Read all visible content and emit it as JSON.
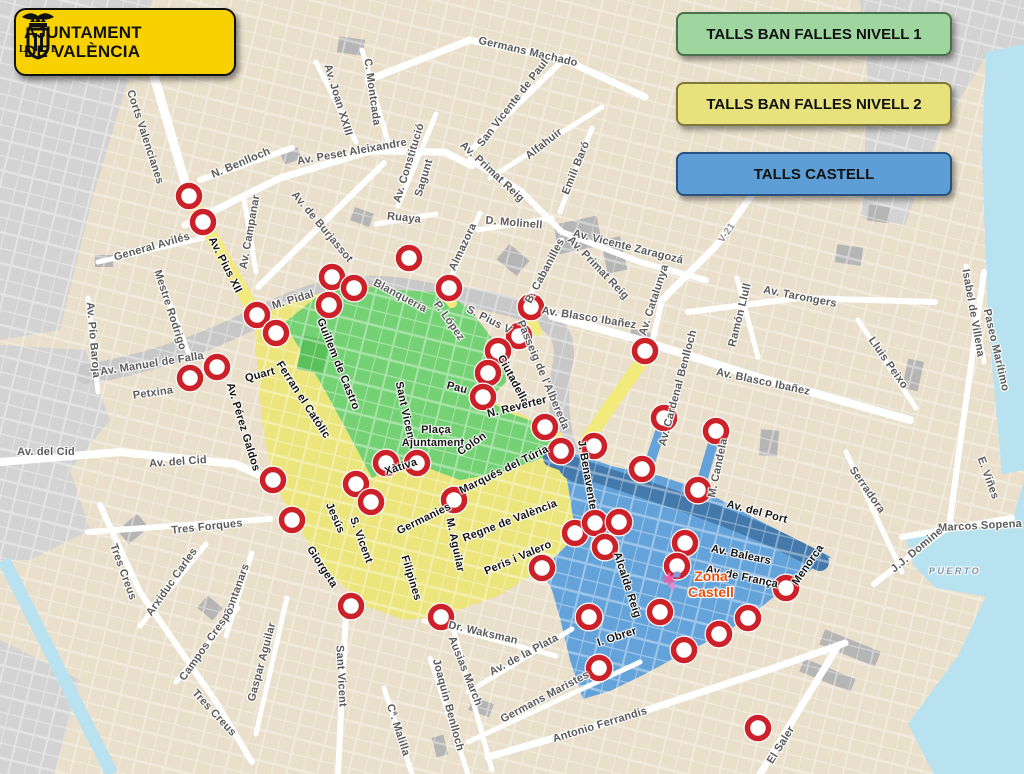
{
  "badge": {
    "line1": "AJUNTAMENT",
    "line2": "DE VALÈNCIA"
  },
  "legend": [
    {
      "label": "TALLS BAN FALLES NIVELL 1",
      "fill": "#9fd6a0",
      "border": "#47714d"
    },
    {
      "label": "TALLS BAN FALLES NIVELL 2",
      "fill": "#e7e27b",
      "border": "#7d7839"
    },
    {
      "label": "TALLS CASTELL",
      "fill": "#5d9ed6",
      "border": "#27517e"
    }
  ],
  "colors": {
    "nivell1": "#74d274",
    "nivell2": "#ece57c",
    "castell": "#64a3da",
    "river": "#4479ab",
    "riverbed": "#c8c8c8",
    "water": "#b8e2ef",
    "margin_gray": "#d3d3d3",
    "building_gray": "#b5b5b5",
    "road_highlight": "#f2ea7a",
    "marker_ring": "#cc2128",
    "marker_fill": "#ffffff",
    "badge_yellow": "#f8d200",
    "park_green": "#5ac05a",
    "zona_castell_text": "#e8500f"
  },
  "zona_castell": {
    "line1": "Zona",
    "line2": "Castell"
  },
  "icons": {
    "fireworks": [
      "✱",
      "✸",
      "✹"
    ]
  },
  "markers": [
    [
      189,
      196
    ],
    [
      203,
      222
    ],
    [
      332,
      277
    ],
    [
      354,
      288
    ],
    [
      329,
      305
    ],
    [
      257,
      315
    ],
    [
      276,
      333
    ],
    [
      217,
      367
    ],
    [
      190,
      378
    ],
    [
      409,
      258
    ],
    [
      449,
      288
    ],
    [
      531,
      307
    ],
    [
      519,
      336
    ],
    [
      498,
      351
    ],
    [
      488,
      373
    ],
    [
      483,
      397
    ],
    [
      545,
      427
    ],
    [
      645,
      351
    ],
    [
      664,
      418
    ],
    [
      716,
      431
    ],
    [
      594,
      446
    ],
    [
      561,
      451
    ],
    [
      642,
      469
    ],
    [
      698,
      490
    ],
    [
      273,
      480
    ],
    [
      292,
      520
    ],
    [
      356,
      484
    ],
    [
      371,
      502
    ],
    [
      386,
      463
    ],
    [
      417,
      463
    ],
    [
      454,
      500
    ],
    [
      351,
      606
    ],
    [
      441,
      617
    ],
    [
      575,
      533
    ],
    [
      595,
      523
    ],
    [
      619,
      522
    ],
    [
      605,
      547
    ],
    [
      542,
      568
    ],
    [
      685,
      543
    ],
    [
      677,
      566
    ],
    [
      589,
      617
    ],
    [
      660,
      612
    ],
    [
      786,
      588
    ],
    [
      748,
      618
    ],
    [
      719,
      634
    ],
    [
      684,
      650
    ],
    [
      599,
      668
    ],
    [
      758,
      728
    ]
  ],
  "labels": [
    {
      "t": "Germans Machado",
      "x": 528,
      "y": 52,
      "r": 13
    },
    {
      "t": "C. Montcada",
      "x": 372,
      "y": 92,
      "r": 82
    },
    {
      "t": "Av. Joan XXIII",
      "x": 338,
      "y": 100,
      "r": 73
    },
    {
      "t": "Av. Peset Aleixandre",
      "x": 352,
      "y": 152,
      "r": -10
    },
    {
      "t": "Av. Constitució",
      "x": 409,
      "y": 163,
      "r": -73
    },
    {
      "t": "Sagunt",
      "x": 424,
      "y": 178,
      "r": -73
    },
    {
      "t": "San Vicente de Paul",
      "x": 513,
      "y": 103,
      "r": -52
    },
    {
      "t": "Av. Primat Reig",
      "x": 492,
      "y": 172,
      "r": 43
    },
    {
      "t": "Alfahuir",
      "x": 544,
      "y": 144,
      "r": -38
    },
    {
      "t": "Emili Baró",
      "x": 576,
      "y": 168,
      "r": -68
    },
    {
      "t": "N. Benlloch",
      "x": 241,
      "y": 163,
      "r": -23
    },
    {
      "t": "Corts Valencianes",
      "x": 145,
      "y": 137,
      "r": 72
    },
    {
      "t": "Ruaya",
      "x": 404,
      "y": 218,
      "r": 6
    },
    {
      "t": "D. Molinell",
      "x": 514,
      "y": 223,
      "r": 5
    },
    {
      "t": "Almazora",
      "x": 463,
      "y": 247,
      "r": -65
    },
    {
      "t": "B. Cabanilles",
      "x": 545,
      "y": 271,
      "r": -62
    },
    {
      "t": "Av. Vicente Zaragozá",
      "x": 628,
      "y": 247,
      "r": 14
    },
    {
      "t": "Av. Primat Reig",
      "x": 598,
      "y": 268,
      "r": 46
    },
    {
      "t": "Av. Catalunya",
      "x": 654,
      "y": 300,
      "r": -72
    },
    {
      "t": "V-21",
      "x": 727,
      "y": 233,
      "r": -55,
      "k": "v"
    },
    {
      "t": "Av. Tarongers",
      "x": 800,
      "y": 297,
      "r": 11
    },
    {
      "t": "Ramón Llull",
      "x": 740,
      "y": 315,
      "r": -76
    },
    {
      "t": "Av. Blasco Ibañez",
      "x": 589,
      "y": 318,
      "r": 9
    },
    {
      "t": "Av. Blasco Ibañez",
      "x": 763,
      "y": 382,
      "r": 12
    },
    {
      "t": "Av. de Burjassot",
      "x": 322,
      "y": 227,
      "r": 50
    },
    {
      "t": "Av. Campanar",
      "x": 250,
      "y": 232,
      "r": -80
    },
    {
      "t": "Av. Pius XII",
      "x": 225,
      "y": 265,
      "r": 63,
      "k": "z"
    },
    {
      "t": "M. Pidal",
      "x": 293,
      "y": 300,
      "r": -17
    },
    {
      "t": "Mestre Rodrigo",
      "x": 170,
      "y": 310,
      "r": 72
    },
    {
      "t": "Av. Pío Baroja",
      "x": 93,
      "y": 340,
      "r": 85
    },
    {
      "t": "Av. Manuel de Falla",
      "x": 152,
      "y": 364,
      "r": -9
    },
    {
      "t": "Petxina",
      "x": 153,
      "y": 393,
      "r": -8
    },
    {
      "t": "Av. del Cid",
      "x": 46,
      "y": 452,
      "r": 0
    },
    {
      "t": "Av. del Cid",
      "x": 178,
      "y": 462,
      "r": -4
    },
    {
      "t": "General Avilés",
      "x": 152,
      "y": 247,
      "r": -16
    },
    {
      "t": "Blanqueria",
      "x": 400,
      "y": 296,
      "r": 28
    },
    {
      "t": "P. López",
      "x": 449,
      "y": 321,
      "r": 55
    },
    {
      "t": "S. Pius V",
      "x": 489,
      "y": 320,
      "r": 27
    },
    {
      "t": "Guillem de  Castro",
      "x": 338,
      "y": 364,
      "r": 68,
      "k": "z"
    },
    {
      "t": "Ferran el Catòlic",
      "x": 303,
      "y": 400,
      "r": 57,
      "k": "z"
    },
    {
      "t": "Quart",
      "x": 260,
      "y": 375,
      "r": -15,
      "k": "z"
    },
    {
      "t": "Av. Pérez Galdos",
      "x": 243,
      "y": 427,
      "r": 73,
      "k": "z"
    },
    {
      "t": "Sant Vicent",
      "x": 405,
      "y": 412,
      "r": 78,
      "k": "z"
    },
    {
      "t": "Pau",
      "x": 457,
      "y": 388,
      "r": 15,
      "k": "z"
    },
    {
      "t": "Plaça",
      "x": 436,
      "y": 430,
      "r": 0,
      "k": "z"
    },
    {
      "t": "Ajuntament",
      "x": 433,
      "y": 443,
      "r": 0,
      "k": "z"
    },
    {
      "t": "Colón",
      "x": 472,
      "y": 444,
      "r": -35,
      "k": "z"
    },
    {
      "t": "Ciutadella",
      "x": 513,
      "y": 380,
      "r": 62,
      "k": "z"
    },
    {
      "t": "N. Reverter",
      "x": 517,
      "y": 407,
      "r": -14,
      "k": "z"
    },
    {
      "t": "Passeig de l'Albereda",
      "x": 543,
      "y": 375,
      "r": 67
    },
    {
      "t": "Marqués del Túria",
      "x": 504,
      "y": 470,
      "r": -26,
      "k": "z"
    },
    {
      "t": "Xàtiva",
      "x": 401,
      "y": 467,
      "r": -18,
      "k": "z"
    },
    {
      "t": "Germanies",
      "x": 424,
      "y": 519,
      "r": -26,
      "k": "z"
    },
    {
      "t": "Regne de València",
      "x": 510,
      "y": 521,
      "r": -21,
      "k": "z"
    },
    {
      "t": "M. Aguilar",
      "x": 455,
      "y": 545,
      "r": 78,
      "k": "z"
    },
    {
      "t": "Peris i Valero",
      "x": 518,
      "y": 558,
      "r": -23,
      "k": "z"
    },
    {
      "t": "Jesús",
      "x": 335,
      "y": 518,
      "r": 66,
      "k": "z"
    },
    {
      "t": "S. Vicent",
      "x": 361,
      "y": 540,
      "r": 70,
      "k": "z"
    },
    {
      "t": "Giorgeta",
      "x": 322,
      "y": 567,
      "r": 57,
      "k": "z"
    },
    {
      "t": "Filipines",
      "x": 411,
      "y": 578,
      "r": 73,
      "k": "z"
    },
    {
      "t": "J. Benavente",
      "x": 587,
      "y": 475,
      "r": 80,
      "k": "z"
    },
    {
      "t": "Av. Cardenal Benlloch",
      "x": 678,
      "y": 388,
      "r": -75
    },
    {
      "t": "M. Candela",
      "x": 718,
      "y": 468,
      "r": -78
    },
    {
      "t": "Av. del Port",
      "x": 757,
      "y": 512,
      "r": 15,
      "k": "z"
    },
    {
      "t": "Av. Balears",
      "x": 741,
      "y": 555,
      "r": 12,
      "k": "z"
    },
    {
      "t": "Av. de França",
      "x": 742,
      "y": 577,
      "r": 12,
      "k": "z"
    },
    {
      "t": "Alcalde Reig",
      "x": 627,
      "y": 585,
      "r": 72,
      "k": "z"
    },
    {
      "t": "I. Obrer",
      "x": 617,
      "y": 637,
      "r": -18,
      "k": "z"
    },
    {
      "t": "Menorca",
      "x": 808,
      "y": 565,
      "r": -55,
      "k": "z"
    },
    {
      "t": "Serradora",
      "x": 867,
      "y": 490,
      "r": 55
    },
    {
      "t": "Marcos Sopena",
      "x": 980,
      "y": 526,
      "r": -3
    },
    {
      "t": "J.J. Domine",
      "x": 917,
      "y": 550,
      "r": -40
    },
    {
      "t": "PUERTO",
      "x": 955,
      "y": 571,
      "r": 0,
      "k": "p"
    },
    {
      "t": "Lluis Peixo",
      "x": 888,
      "y": 363,
      "r": 55
    },
    {
      "t": "Isabel de Villena",
      "x": 973,
      "y": 313,
      "r": 80
    },
    {
      "t": "Paseo Marítimo",
      "x": 996,
      "y": 350,
      "r": 77
    },
    {
      "t": "E. Viñes",
      "x": 988,
      "y": 478,
      "r": 70
    },
    {
      "t": "Dr. Waksman",
      "x": 483,
      "y": 633,
      "r": 13
    },
    {
      "t": "Av. de la Plata",
      "x": 524,
      "y": 655,
      "r": -28
    },
    {
      "t": "Ausias March",
      "x": 465,
      "y": 671,
      "r": 68
    },
    {
      "t": "Joaquin Benlloch",
      "x": 448,
      "y": 705,
      "r": 75
    },
    {
      "t": "Cª. Malilla",
      "x": 398,
      "y": 730,
      "r": 72
    },
    {
      "t": "Germans Maristes",
      "x": 545,
      "y": 697,
      "r": -28
    },
    {
      "t": "Antonio Ferrandis",
      "x": 600,
      "y": 725,
      "r": -17
    },
    {
      "t": "El Saler",
      "x": 781,
      "y": 745,
      "r": -58
    },
    {
      "t": "Tres Forques",
      "x": 207,
      "y": 527,
      "r": -6
    },
    {
      "t": "Tres Creus",
      "x": 123,
      "y": 572,
      "r": 70
    },
    {
      "t": "Tres Creus",
      "x": 214,
      "y": 713,
      "r": 47
    },
    {
      "t": "Arxiduc Carles",
      "x": 172,
      "y": 582,
      "r": -55
    },
    {
      "t": "Fontanars",
      "x": 237,
      "y": 590,
      "r": -70
    },
    {
      "t": "Campos Crespo",
      "x": 207,
      "y": 644,
      "r": -55
    },
    {
      "t": "Gaspar Aguilar",
      "x": 262,
      "y": 662,
      "r": -75
    },
    {
      "t": "Sant Vicent",
      "x": 341,
      "y": 676,
      "r": 87
    }
  ]
}
